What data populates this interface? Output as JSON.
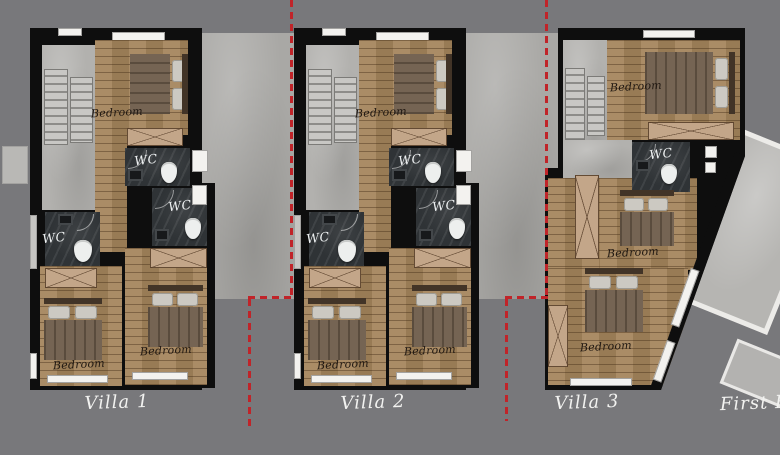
{
  "floor_plan": {
    "floor_label": "First Floor",
    "villas": [
      {
        "name": "Villa 1",
        "rooms": [
          {
            "label": "Bedroom",
            "position": "top"
          },
          {
            "label": "WC",
            "position": "upper-middle"
          },
          {
            "label": "WC",
            "position": "middle"
          },
          {
            "label": "WC",
            "position": "left"
          },
          {
            "label": "Bedroom",
            "position": "bottom-left"
          },
          {
            "label": "Bedroom",
            "position": "bottom-right"
          }
        ]
      },
      {
        "name": "Villa 2",
        "rooms": [
          {
            "label": "Bedroom",
            "position": "top"
          },
          {
            "label": "WC",
            "position": "upper-middle"
          },
          {
            "label": "WC",
            "position": "middle"
          },
          {
            "label": "WC",
            "position": "left"
          },
          {
            "label": "Bedroom",
            "position": "bottom-left"
          },
          {
            "label": "Bedroom",
            "position": "bottom-right"
          }
        ]
      },
      {
        "name": "Villa 3",
        "rooms": [
          {
            "label": "Bedroom",
            "position": "top"
          },
          {
            "label": "WC",
            "position": "middle-right"
          },
          {
            "label": "Bedroom",
            "position": "middle"
          },
          {
            "label": "Bedroom",
            "position": "bottom"
          }
        ]
      }
    ],
    "colors": {
      "background": "#78787b",
      "walls": "#0e0e0e",
      "wood_floor": "#a5855c",
      "wet_room_floor": "#2f3336",
      "concrete": "#b2b1ae",
      "closet": "#c3a689",
      "boundary_dashes": "#c02429",
      "room_label_text": "#201812",
      "villa_label_text": "#f2f2f0"
    }
  }
}
